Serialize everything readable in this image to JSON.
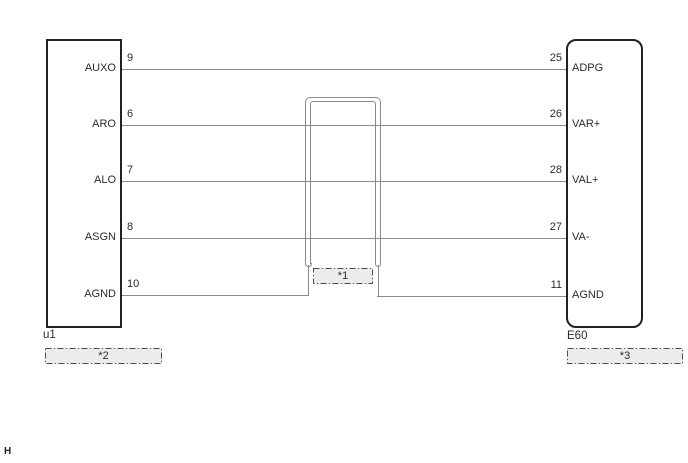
{
  "connectors": {
    "left": {
      "id": "u1",
      "callout": "*2"
    },
    "right": {
      "id": "E60",
      "callout": "*3"
    }
  },
  "shield": {
    "callout": "*1"
  },
  "connections": [
    {
      "left_pin": "9",
      "left_label": "AUXO",
      "right_pin": "25",
      "right_label": "ADPG"
    },
    {
      "left_pin": "6",
      "left_label": "ARO",
      "right_pin": "26",
      "right_label": "VAR+"
    },
    {
      "left_pin": "7",
      "left_label": "ALO",
      "right_pin": "28",
      "right_label": "VAL+"
    },
    {
      "left_pin": "8",
      "left_label": "ASGN",
      "right_pin": "27",
      "right_label": "VA-"
    },
    {
      "left_pin": "10",
      "left_label": "AGND",
      "right_pin": "11",
      "right_label": "AGND"
    }
  ],
  "page_marker": "H",
  "colors": {
    "background": "#ffffff",
    "box_border": "#222222",
    "wire": "#8a8a8a",
    "text": "#2b2b2b",
    "callout_fill": "#ececec",
    "callout_border": "#4d4d4d"
  }
}
